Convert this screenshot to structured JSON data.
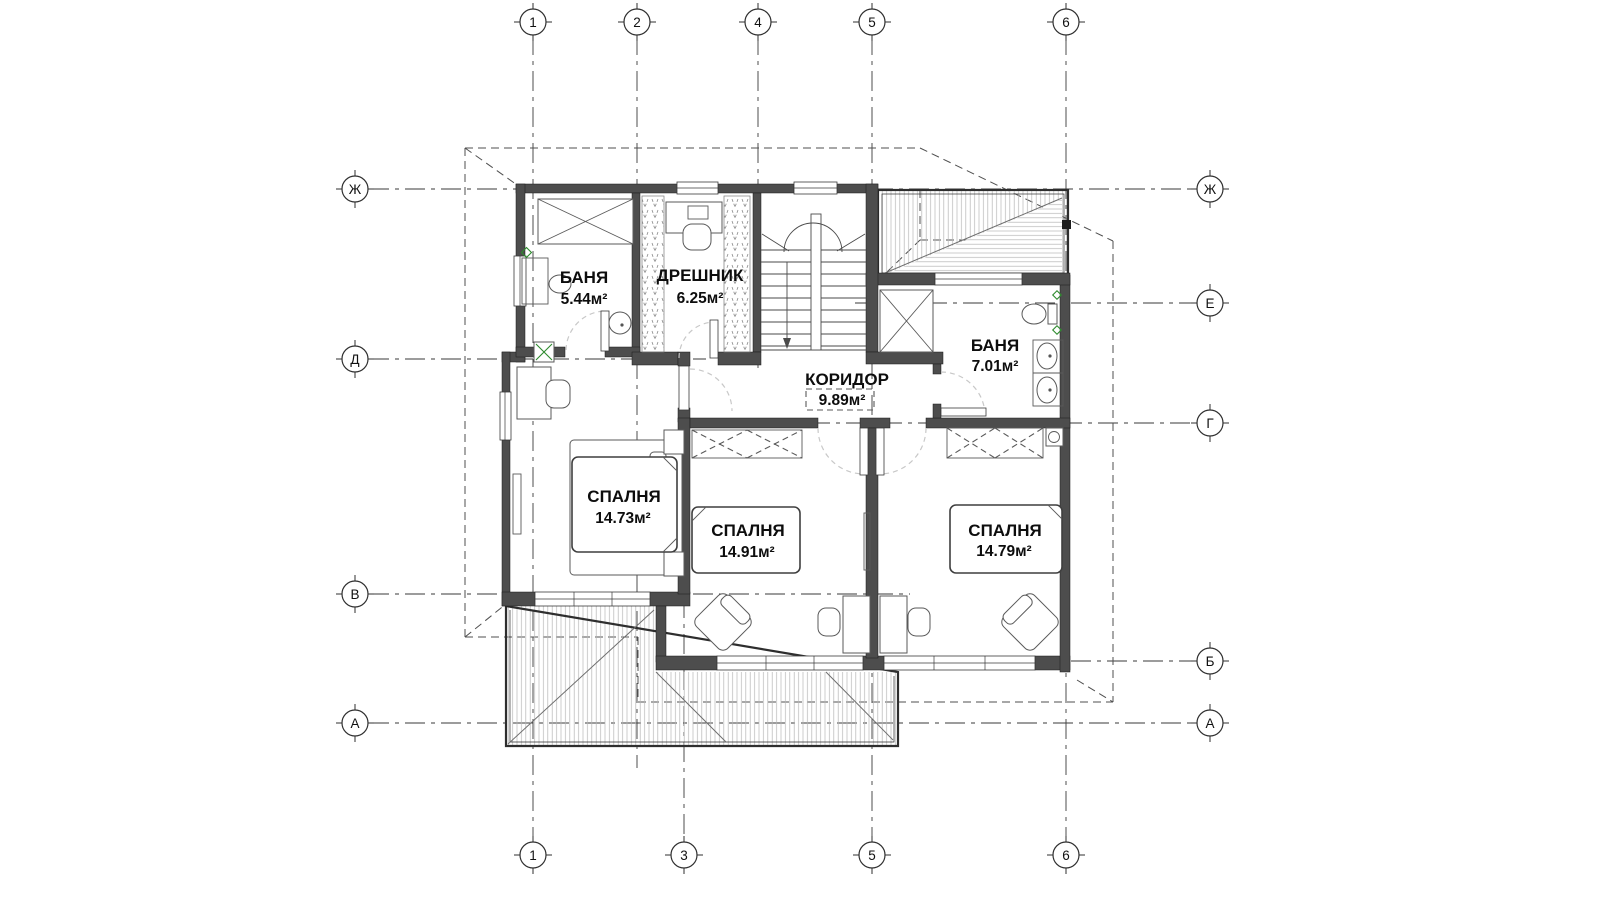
{
  "rooms": [
    {
      "name": "БАНЯ",
      "area": "5.44м²"
    },
    {
      "name": "ДРЕШНИК",
      "area": "6.25м²"
    },
    {
      "name": "КОРИДОР",
      "area": "9.89м²"
    },
    {
      "name": "БАНЯ",
      "area": "7.01м²"
    },
    {
      "name": "СПАЛНЯ",
      "area": "14.73м²"
    },
    {
      "name": "СПАЛНЯ",
      "area": "14.91м²"
    },
    {
      "name": "СПАЛНЯ",
      "area": "14.79м²"
    }
  ],
  "axes": {
    "top": [
      "1",
      "2",
      "4",
      "5",
      "6"
    ],
    "bottom": [
      "1",
      "3",
      "5",
      "6"
    ],
    "left": [
      "Ж",
      "Д",
      "В",
      "А"
    ],
    "right": [
      "Ж",
      "Е",
      "Г",
      "Б",
      "А"
    ]
  },
  "colors": {
    "wall": "#4d4d4d",
    "hatch": "#b5b5b5",
    "accent_green": "#2e8b2e",
    "line": "#2f2f2f"
  }
}
